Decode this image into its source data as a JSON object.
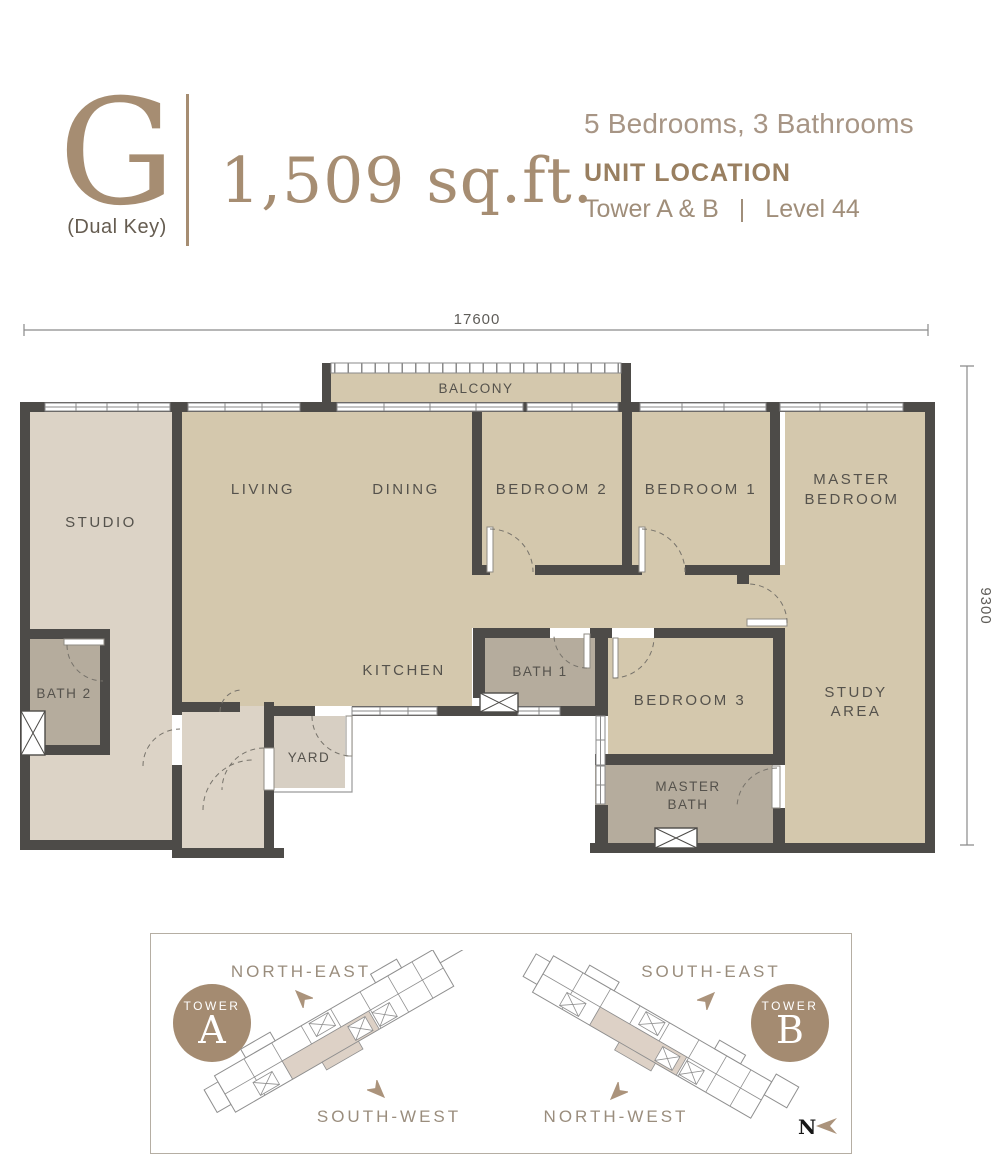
{
  "header": {
    "unit_letter": "G",
    "unit_type": "(Dual Key)",
    "area": "1,509 sq.ft.",
    "bed_bath": "5 Bedrooms, 3 Bathrooms",
    "unit_location_title": "UNIT LOCATION",
    "towers": "Tower A & B",
    "separator": "|",
    "level": "Level 44"
  },
  "floor_plan": {
    "dimension_width": "17600",
    "dimension_depth": "9300",
    "rooms": {
      "balcony": "BALCONY",
      "studio": "STUDIO",
      "living": "LIVING",
      "dining": "DINING",
      "bedroom2": "BEDROOM 2",
      "bedroom1": "BEDROOM 1",
      "master_bedroom_line1": "MASTER",
      "master_bedroom_line2": "BEDROOM",
      "bath2": "BATH 2",
      "kitchen": "KITCHEN",
      "bath1": "BATH 1",
      "bedroom3": "BEDROOM 3",
      "study_line1": "STUDY",
      "study_line2": "AREA",
      "yard": "YARD",
      "master_bath_line1": "MASTER",
      "master_bath_line2": "BATH"
    }
  },
  "location_panel": {
    "tower_a": {
      "circle_label": "TOWER",
      "circle_letter": "A",
      "direction_top": "NORTH-EAST",
      "direction_bottom": "SOUTH-WEST"
    },
    "tower_b": {
      "circle_label": "TOWER",
      "circle_letter": "B",
      "direction_top": "SOUTH-EAST",
      "direction_bottom": "NORTH-WEST"
    },
    "compass_label": "N"
  },
  "colors": {
    "accent_brown": "#a68d72",
    "wall": "#4d4b48",
    "floor_tan": "#d4c8ad",
    "floor_light": "#dcd3c6",
    "floor_bath": "#b5ac9d",
    "highlight_unit": "#ddd1c6"
  }
}
